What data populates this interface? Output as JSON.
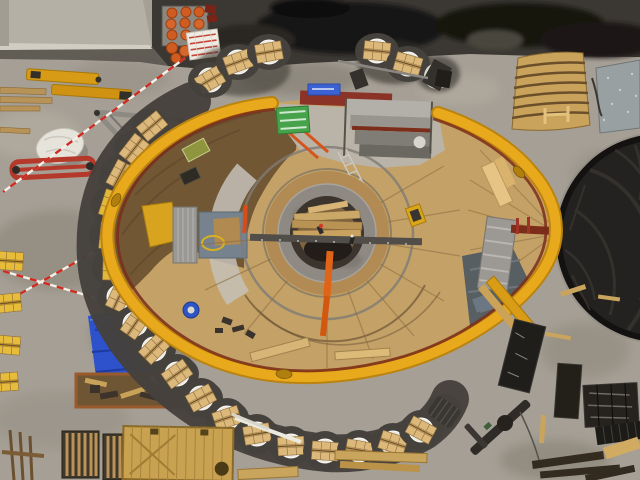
{
  "meta": {
    "title": "Aerial top-down view of a circular construction shaft site",
    "type": "aerial-photograph",
    "visible_text": "none"
  },
  "palette": {
    "ground": "#a59f95",
    "groundLight": "#b7b1a6",
    "groundDark": "#8c867c",
    "asphalt": "#3b3833",
    "asphaltWet": "#151413",
    "slab": "#b5b0a5",
    "membrane": "#242220",
    "membraneStreak": "#3a3731",
    "yellow": "#e9a91d",
    "yellowDark": "#bb8410",
    "maroon": "#7b2d1a",
    "deckLight": "#c4a267",
    "deckMid": "#a5834f",
    "deckDark": "#6e5433",
    "apron": "#b9b5ac",
    "ringConcrete": "#8e8983",
    "ringShadow": "#3b352e",
    "padMat": "#45413c",
    "plate": "#ece9e1",
    "crate": "#cfa96a",
    "crateTop": "#dcb87a",
    "steel": "#9a9792",
    "blueTarp": "#2d52cc",
    "blueSign": "#3a62d4",
    "grayTarp": "#585f62",
    "red": "#b5392a",
    "orange": "#d4561c",
    "orangeDrum": "#cf5c20",
    "green": "#47a34b",
    "tapeRed": "#cf2b20",
    "tapeWhite": "#f2efe8"
  },
  "scene": {
    "labels": {
      "site": "construction site aerial view",
      "roofSlab": "concrete building roof, top-left",
      "asphaltStrip": "dark asphalt strip along top",
      "membraneCircle": "black membrane covered circular pit, right",
      "ovalDeck": "oval timber working deck with yellow edge beams",
      "yellowRim": "yellow curved perimeter beams",
      "centralShaft": "circular concrete shaft with timber bridge",
      "padChain": "chain of black pads with timber crates",
      "topPallets": "pallets with orange drums and boxed goods",
      "leftYard": "laydown yard with scaffolding, bag, tarp and tape",
      "bottomYard": "timber racks, wooden container and planks",
      "rightYard": "wrapped panel stacks and timbers",
      "timberStack": "curved timber segment stack",
      "steelPlates": "galvanized steel plate stack",
      "grayTarpOnDeck": "gray tarp draped on deck",
      "workers": "workers near shaft center"
    }
  }
}
